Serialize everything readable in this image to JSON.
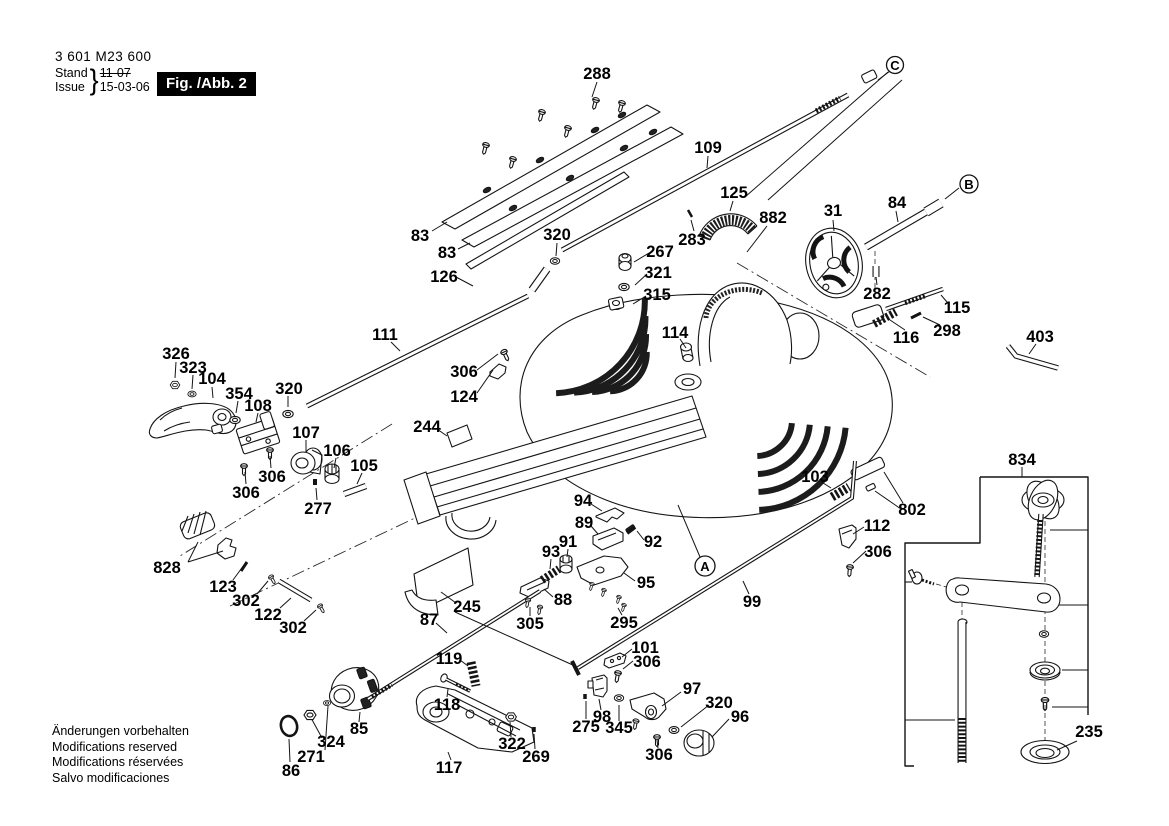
{
  "header": {
    "type_number": "3 601 M23 600",
    "stand_label": "Stand",
    "issue_label": "Issue",
    "brace": "}",
    "stand_value": "11-07",
    "issue_value": "15-03-06",
    "figure_label": "Fig. /Abb. 2"
  },
  "footer": {
    "lines": [
      "Änderungen vorbehalten",
      "Modifications reserved",
      "Modifications réservées",
      "Salvo modificaciones"
    ]
  },
  "diagram": {
    "ink_color": "#141414",
    "background": "#ffffff",
    "ref_markers": [
      {
        "text": "C",
        "x": 895,
        "y": 65,
        "r": 8.5
      },
      {
        "text": "B",
        "x": 969,
        "y": 184,
        "r": 9
      },
      {
        "text": "A",
        "x": 705,
        "y": 566,
        "r": 10
      }
    ],
    "part_labels": [
      {
        "text": "288",
        "x": 597,
        "y": 74
      },
      {
        "text": "109",
        "x": 708,
        "y": 148
      },
      {
        "text": "83",
        "x": 420,
        "y": 236
      },
      {
        "text": "83",
        "x": 447,
        "y": 253
      },
      {
        "text": "320",
        "x": 557,
        "y": 235
      },
      {
        "text": "126",
        "x": 444,
        "y": 277
      },
      {
        "text": "125",
        "x": 734,
        "y": 193
      },
      {
        "text": "882",
        "x": 773,
        "y": 218
      },
      {
        "text": "283",
        "x": 692,
        "y": 240
      },
      {
        "text": "267",
        "x": 660,
        "y": 252
      },
      {
        "text": "321",
        "x": 658,
        "y": 273
      },
      {
        "text": "315",
        "x": 657,
        "y": 295
      },
      {
        "text": "31",
        "x": 833,
        "y": 211
      },
      {
        "text": "84",
        "x": 897,
        "y": 203
      },
      {
        "text": "282",
        "x": 877,
        "y": 294
      },
      {
        "text": "115",
        "x": 957,
        "y": 308
      },
      {
        "text": "298",
        "x": 947,
        "y": 331
      },
      {
        "text": "116",
        "x": 906,
        "y": 338
      },
      {
        "text": "403",
        "x": 1040,
        "y": 337
      },
      {
        "text": "111",
        "x": 385,
        "y": 335
      },
      {
        "text": "114",
        "x": 675,
        "y": 333
      },
      {
        "text": "306",
        "x": 464,
        "y": 372
      },
      {
        "text": "124",
        "x": 464,
        "y": 397
      },
      {
        "text": "244",
        "x": 427,
        "y": 427
      },
      {
        "text": "326",
        "x": 176,
        "y": 354
      },
      {
        "text": "323",
        "x": 193,
        "y": 368
      },
      {
        "text": "104",
        "x": 212,
        "y": 379
      },
      {
        "text": "354",
        "x": 239,
        "y": 394
      },
      {
        "text": "108",
        "x": 258,
        "y": 406
      },
      {
        "text": "320",
        "x": 289,
        "y": 389
      },
      {
        "text": "107",
        "x": 306,
        "y": 433
      },
      {
        "text": "106",
        "x": 337,
        "y": 451
      },
      {
        "text": "105",
        "x": 364,
        "y": 466
      },
      {
        "text": "306",
        "x": 272,
        "y": 477
      },
      {
        "text": "306",
        "x": 246,
        "y": 493
      },
      {
        "text": "277",
        "x": 318,
        "y": 509
      },
      {
        "text": "828",
        "x": 167,
        "y": 568
      },
      {
        "text": "123",
        "x": 223,
        "y": 587
      },
      {
        "text": "302",
        "x": 246,
        "y": 601
      },
      {
        "text": "122",
        "x": 268,
        "y": 615
      },
      {
        "text": "302",
        "x": 293,
        "y": 628
      },
      {
        "text": "94",
        "x": 583,
        "y": 501
      },
      {
        "text": "89",
        "x": 584,
        "y": 523
      },
      {
        "text": "92",
        "x": 653,
        "y": 542
      },
      {
        "text": "91",
        "x": 568,
        "y": 542
      },
      {
        "text": "93",
        "x": 551,
        "y": 552
      },
      {
        "text": "95",
        "x": 646,
        "y": 583
      },
      {
        "text": "88",
        "x": 563,
        "y": 600
      },
      {
        "text": "245",
        "x": 467,
        "y": 607
      },
      {
        "text": "87",
        "x": 429,
        "y": 620
      },
      {
        "text": "305",
        "x": 530,
        "y": 624
      },
      {
        "text": "295",
        "x": 624,
        "y": 623
      },
      {
        "text": "103",
        "x": 815,
        "y": 477
      },
      {
        "text": "802",
        "x": 912,
        "y": 510
      },
      {
        "text": "112",
        "x": 877,
        "y": 526
      },
      {
        "text": "306",
        "x": 878,
        "y": 552
      },
      {
        "text": "834",
        "x": 1022,
        "y": 460
      },
      {
        "text": "99",
        "x": 752,
        "y": 602
      },
      {
        "text": "119",
        "x": 449,
        "y": 659
      },
      {
        "text": "118",
        "x": 447,
        "y": 705
      },
      {
        "text": "101",
        "x": 645,
        "y": 648
      },
      {
        "text": "306",
        "x": 647,
        "y": 662
      },
      {
        "text": "117",
        "x": 449,
        "y": 768
      },
      {
        "text": "322",
        "x": 512,
        "y": 744
      },
      {
        "text": "269",
        "x": 536,
        "y": 757
      },
      {
        "text": "86",
        "x": 291,
        "y": 771
      },
      {
        "text": "271",
        "x": 311,
        "y": 757
      },
      {
        "text": "324",
        "x": 331,
        "y": 742
      },
      {
        "text": "85",
        "x": 359,
        "y": 729
      },
      {
        "text": "98",
        "x": 602,
        "y": 717
      },
      {
        "text": "275",
        "x": 586,
        "y": 727
      },
      {
        "text": "345",
        "x": 619,
        "y": 728
      },
      {
        "text": "97",
        "x": 692,
        "y": 689
      },
      {
        "text": "320",
        "x": 719,
        "y": 703
      },
      {
        "text": "96",
        "x": 740,
        "y": 717
      },
      {
        "text": "306",
        "x": 659,
        "y": 755
      },
      {
        "text": "235",
        "x": 1089,
        "y": 732
      }
    ]
  }
}
